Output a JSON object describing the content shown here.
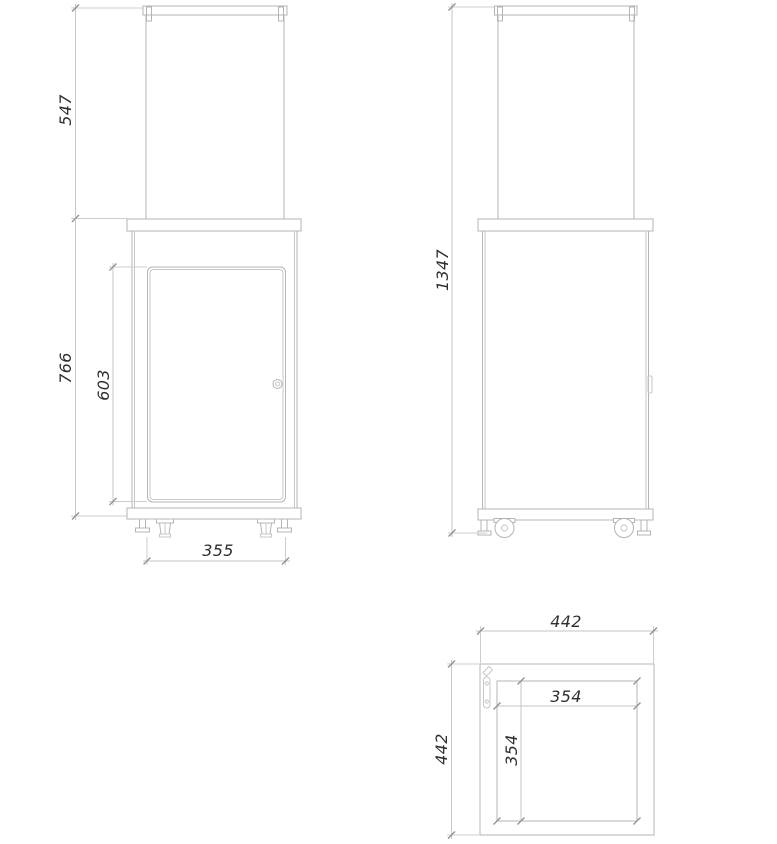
{
  "drawing": {
    "type": "technical-orthographic-drawing",
    "dims": {
      "front": {
        "glass_section_height": "547",
        "cabinet_height": "766",
        "door_height": "603",
        "base_width": "355"
      },
      "side": {
        "overall_height": "1347"
      },
      "top": {
        "overall_width": "442",
        "overall_depth": "442",
        "inner_width": "354",
        "inner_depth": "354"
      }
    },
    "colors": {
      "object_line": "#b2b5b8",
      "object_line_light": "#c6c8ca",
      "dim_line": "#c4c6c8",
      "ext_line": "#cbcdcf",
      "tick": "#8e9093",
      "text": "#2f2f2f",
      "background": "#ffffff"
    }
  }
}
